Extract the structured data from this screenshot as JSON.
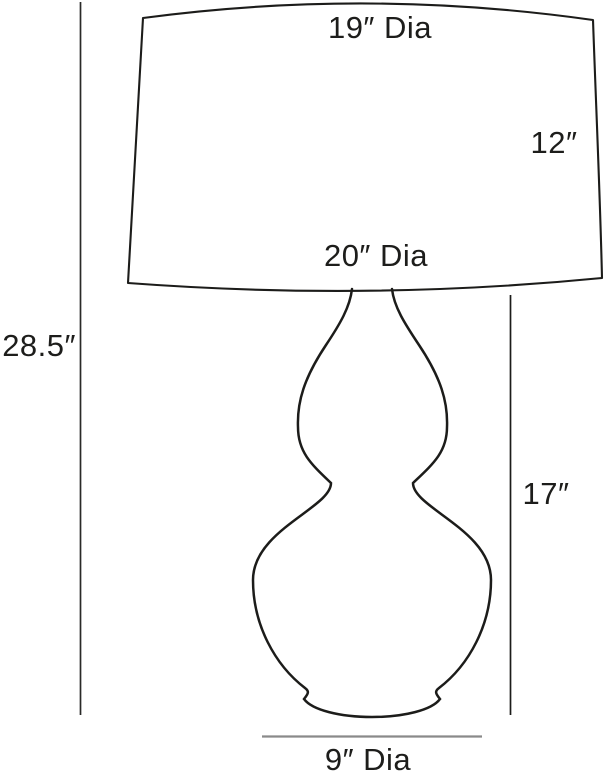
{
  "diagram": {
    "labels": {
      "shade_top_diameter": "19″ Dia",
      "shade_height": "12″",
      "shade_bottom_diameter": "20″ Dia",
      "overall_height": "28.5″",
      "base_height": "17″",
      "base_bottom_diameter": "9″ Dia"
    },
    "colors": {
      "outline": "#1c1c1a",
      "dimension_line": "#2a2a28",
      "base_diameter_line": "#8a8a8a",
      "text": "#1d1d1b",
      "background": "#ffffff"
    }
  }
}
